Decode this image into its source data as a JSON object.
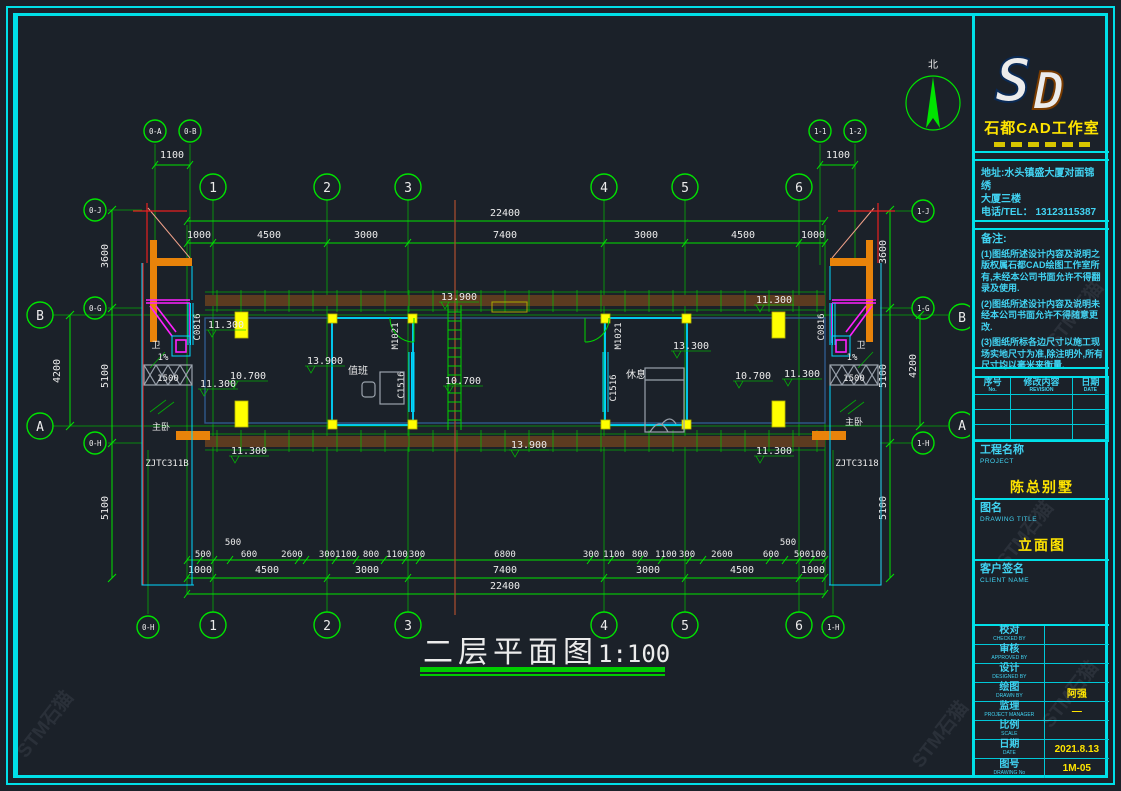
{
  "wm": "STM石猫",
  "tb": {
    "studio": "石都CAD工作室",
    "addr1": "地址:水头镇盛大厦对面锦绣",
    "addr2": "大厦三楼",
    "addr3": "电话/TEL： 13123115387",
    "notes_title": "备注:",
    "note1": "(1)图纸所述设计内容及说明之版权属石都CAD绘图工作室所有,未经本公司书面允许不得翻录及使用.",
    "note2": "(2)图纸所述设计内容及说明未经本公司书面允许不得随意更改.",
    "note3": "(3)图纸所标各边尺寸以施工现场实地尺寸为准,除注明外,所有尺寸均以毫米来衡量.",
    "rev": {
      "h1": "序号",
      "h1e": "No.",
      "h2": "修改内容",
      "h2e": "REVISION",
      "h3": "日期",
      "h3e": "DATE"
    },
    "proj_cn": "工程名称",
    "proj_en": "PROJECT",
    "proj_val": "陈总别墅",
    "draw_cn": "图名",
    "draw_en": "DRAWING TITLE",
    "draw_val": "立面图",
    "client_cn": "客户签名",
    "client_en": "CLIENT NAME",
    "rows": [
      {
        "cn": "校对",
        "en": "CHECKED BY",
        "v": ""
      },
      {
        "cn": "审核",
        "en": "APPROVED BY",
        "v": ""
      },
      {
        "cn": "设计",
        "en": "DESIGNED BY",
        "v": ""
      },
      {
        "cn": "绘图",
        "en": "DRAWN BY",
        "v": "阿强"
      },
      {
        "cn": "监理",
        "en": "PROJECT MANAGER",
        "v": "—"
      },
      {
        "cn": "比例",
        "en": "SCALE",
        "v": ""
      },
      {
        "cn": "日期",
        "en": "DATE",
        "v": "2021.8.13"
      },
      {
        "cn": "图号",
        "en": "DRAWING No",
        "v": "1M-05"
      }
    ]
  },
  "plan": {
    "title": "二层平面图",
    "scale": "1:100",
    "north": "北",
    "cols": [
      "1",
      "2",
      "3",
      "4",
      "5",
      "6"
    ],
    "rowB": "B",
    "rowA": "A",
    "aux": {
      "a0A": "0-A",
      "a0B": "0-B",
      "a11": "1-1",
      "a12": "1-2",
      "a0J": "0-J",
      "a0G": "0-G",
      "a0H": "0-H",
      "a1J": "1-J",
      "a1G": "1-G",
      "a1H": "1-H"
    },
    "d": {
      "d1100": "1100",
      "total": "22400",
      "seg": [
        "1000",
        "4500",
        "3000",
        "7400",
        "3000",
        "4500",
        "1000"
      ],
      "fine": [
        "500",
        "500",
        "600",
        "2600",
        "300",
        "1100",
        "800",
        "1100",
        "300",
        "6800",
        "300",
        "1100",
        "800",
        "1100",
        "300",
        "2600",
        "600",
        "500",
        "500",
        "100"
      ],
      "v3600": "3600",
      "v5100": "5100",
      "v4200": "4200",
      "sill": "1500"
    },
    "lv": {
      "l139": "13.900",
      "l133": "13.300",
      "l113": "11.300",
      "l107": "10.700"
    },
    "rm": {
      "duty": "值班",
      "rest": "休息",
      "master": "主卧",
      "wc": "卫",
      "slope": "1%"
    },
    "cd": {
      "c0816": "C0816",
      "c1516": "C1516",
      "m1021": "M1021",
      "zl": "ZJTC311B",
      "zr": "ZJTC3118"
    }
  }
}
